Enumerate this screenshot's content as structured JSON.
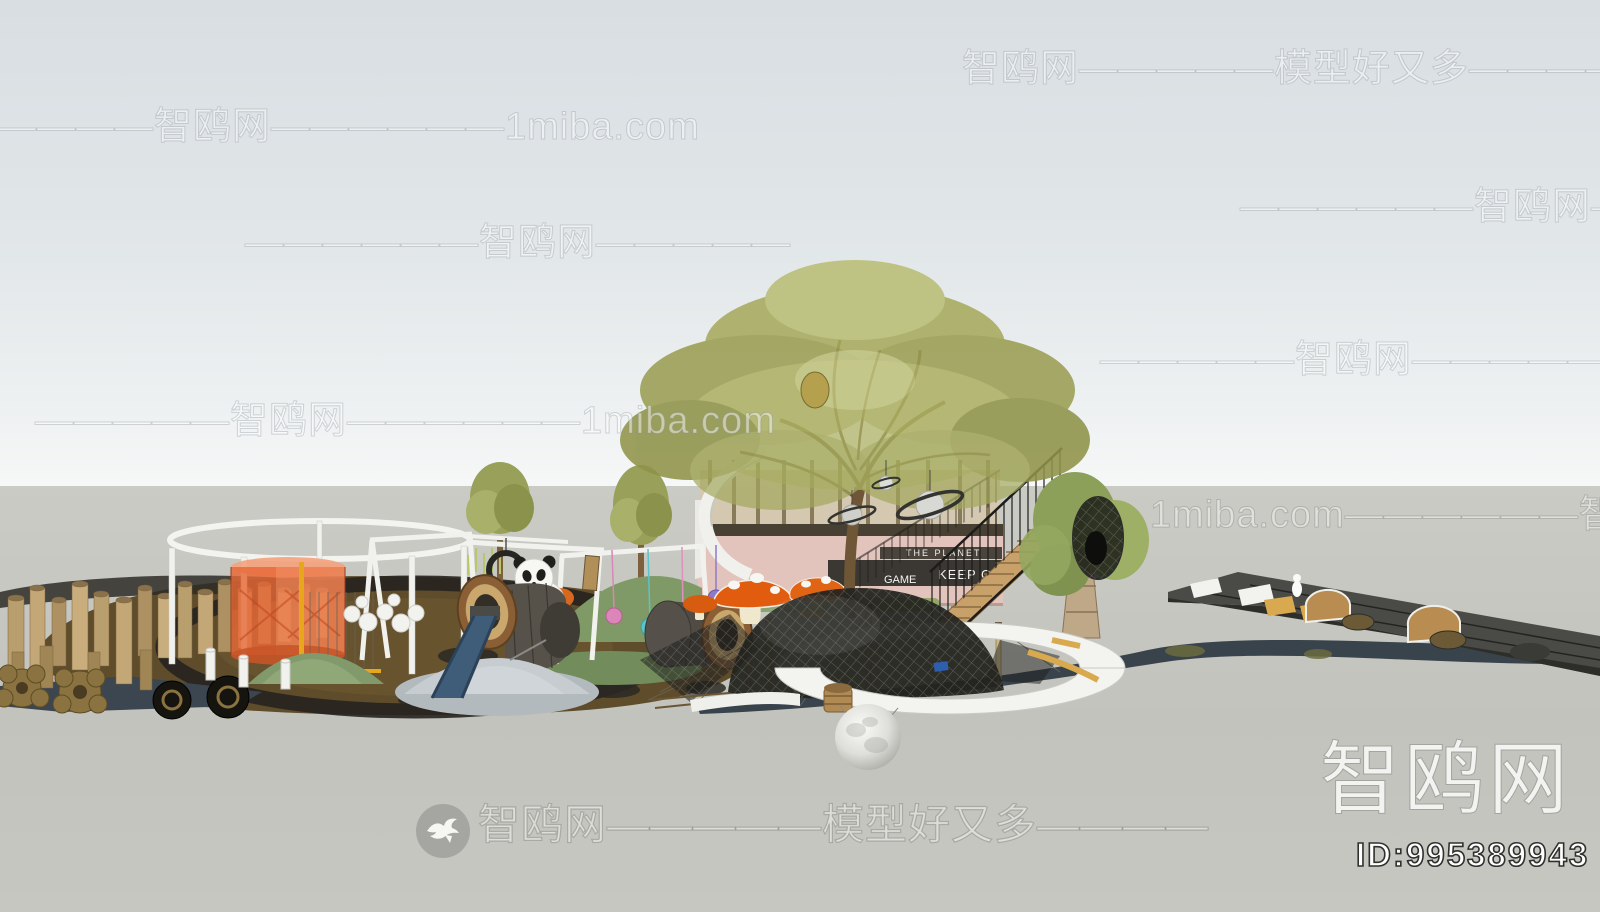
{
  "site": {
    "name": "智鸥网",
    "tagline": "模型好又多",
    "alt_domain": "1miba.com",
    "model_id": "ID:995389943"
  },
  "watermarks": {
    "top_right": "智鸥网—————模型好又多————",
    "top_left": "——————智鸥网——————1miba.com",
    "mid_right_1": "——————智鸥网——————",
    "mid_left_1": "——————智鸥网—————",
    "mid_right_2": "—————智鸥网—————1miba.com",
    "mid_left_2": "—————智鸥网——————1miba.com",
    "mid_right_3": "1miba.com——————智鸥网—————",
    "bottom_center": "智鸥网—————模型好又多————",
    "corner_brand": "智鸥网",
    "corner_id": "ID:995389943"
  },
  "scene": {
    "description": "SketchUp-style 3D render of a children's playground: log stumps, orange mesh cylinder, swings, panda sculpture, log tunnels, blue slide, mushroom sculptures, climbing-net dome over a moon sphere on a white ring walkway, treehouse deck with stairs under a large tree, wicker nest pod tree, elevated dark track",
    "signs": {
      "sign_planet": "THE PLANET",
      "sign_game": "GAME",
      "sign_keep": "KEEP GO"
    },
    "colors": {
      "sky_top": "#d8dee2",
      "sky_horizon": "#f6f7f7",
      "ground": "#c3c3bd",
      "surfacing_brown": "#5e4c2a",
      "path_slate": "#39434c",
      "charcoal_ring": "#26241f",
      "stump_wood": "#c4a777",
      "orange_cylinder": "#e66836",
      "mushroom_orange": "#e25c10",
      "slide_blue": "#3f5d78",
      "foliage_olive": "#a8aa5e",
      "net_black": "#23231f",
      "platform_white": "#f3f3f0",
      "pink_facade": "#e3c4bd",
      "gold_marking": "#d8a94e",
      "stair_wood": "#c7a06a"
    }
  }
}
